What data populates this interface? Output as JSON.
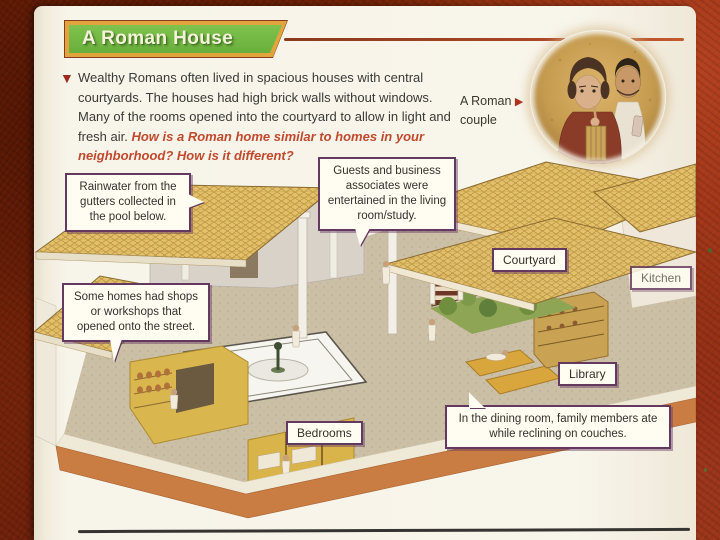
{
  "page": {
    "header": {
      "title": "A Roman House"
    },
    "intro": {
      "bullet": "▼",
      "text": "Wealthy Romans often lived in spacious houses with central courtyards. The houses had high brick walls without windows. Many of the rooms opened into the courtyard to allow in light and fresh air. ",
      "question": "How is a Roman home similar to homes in your neighborhood? How is it different?"
    },
    "photo": {
      "caption_line1": "A Roman",
      "caption_line2": "couple",
      "arrow": "▶"
    },
    "callouts": [
      {
        "id": "rainwater",
        "text": "Rainwater from the gutters collected in the pool below."
      },
      {
        "id": "guests",
        "text": "Guests and business associates were entertained in the living room/study."
      },
      {
        "id": "shops",
        "text": "Some homes had shops or workshops that opened onto the street."
      },
      {
        "id": "dining",
        "text": "In the dining room, family members ate while reclining on couches."
      }
    ],
    "room_labels": [
      {
        "id": "courtyard",
        "text": "Courtyard"
      },
      {
        "id": "kitchen",
        "text": "Kitchen"
      },
      {
        "id": "library",
        "text": "Library"
      },
      {
        "id": "bedrooms",
        "text": "Bedrooms"
      }
    ]
  },
  "colors": {
    "banner_green": "#6aaf3c",
    "banner_border_orange": "#e2a43c",
    "rule_red": "#a84526",
    "question_red": "#c14a2e",
    "label_border_purple": "#64395f",
    "label_bg": "#fffdf2",
    "page_cream": "#f7f4ea",
    "frame_red_dark": "#7c2708",
    "frame_red_bright": "#a83d22",
    "roof_tile_tan": "#e3c069",
    "base_terracotta": "#c97d43"
  }
}
